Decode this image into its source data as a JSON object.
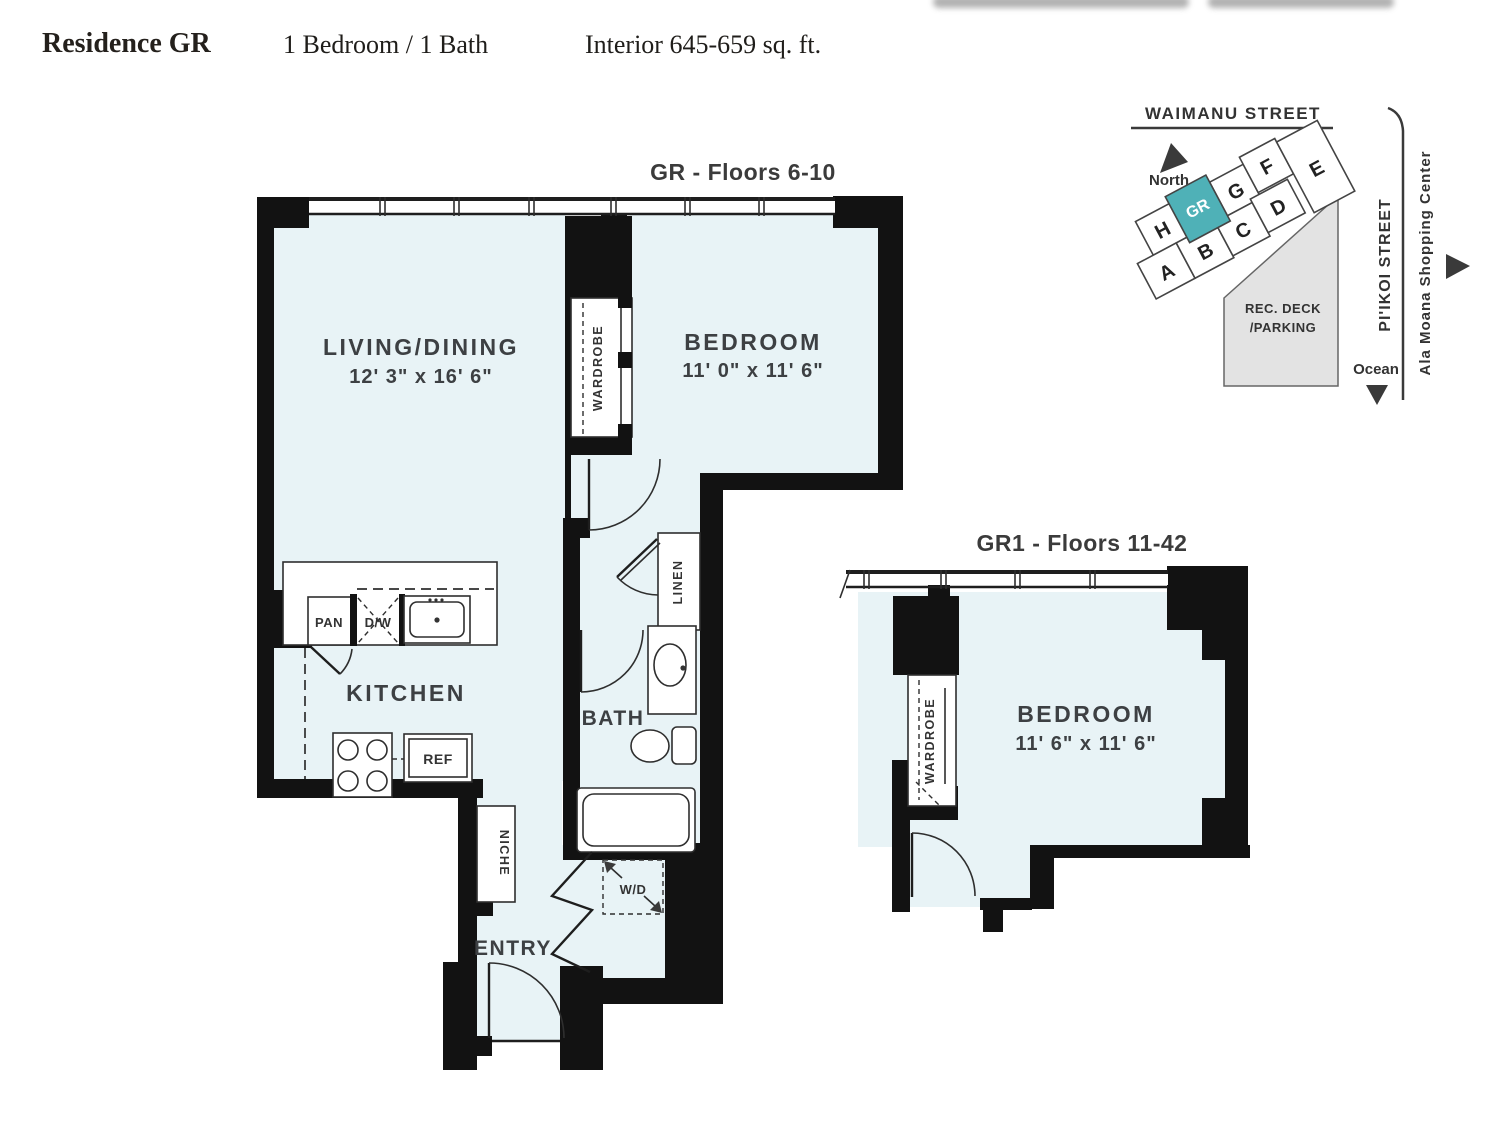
{
  "header": {
    "title": "Residence GR",
    "config": "1 Bedroom / 1 Bath",
    "area": "Interior 645-659 sq. ft."
  },
  "plans": {
    "gr": {
      "title": "GR - Floors 6-10",
      "living": {
        "name": "LIVING/DINING",
        "dims": "12' 3\" x 16' 6\""
      },
      "bedroom": {
        "name": "BEDROOM",
        "dims": "11' 0\" x 11' 6\""
      },
      "kitchen": "KITCHEN",
      "bath": "BATH",
      "entry": "ENTRY",
      "wardrobe": "WARDROBE",
      "linen": "LINEN",
      "niche": "NICHE",
      "wd": "W/D",
      "pan": "PAN",
      "dw": "D/W",
      "ref": "REF"
    },
    "gr1": {
      "title": "GR1 - Floors 11-42",
      "bedroom": {
        "name": "BEDROOM",
        "dims": "11' 6\" x 11' 6\""
      },
      "wardrobe": "WARDROBE"
    }
  },
  "map": {
    "street_top": "WAIMANU STREET",
    "north_label": "North",
    "units": [
      "H",
      "GR",
      "G",
      "F",
      "E",
      "A",
      "B",
      "C",
      "D"
    ],
    "highlighted_unit": "GR",
    "deck_line1": "REC. DECK",
    "deck_line2": "/PARKING",
    "street_right": "PI'IKOI STREET",
    "landmark": "Ala Moana Shopping Center",
    "ocean_label": "Ocean",
    "colors": {
      "highlight": "#4fb1b7",
      "floor": "#e8f3f6",
      "wall": "#111111",
      "deck": "#e3e3e3"
    }
  }
}
